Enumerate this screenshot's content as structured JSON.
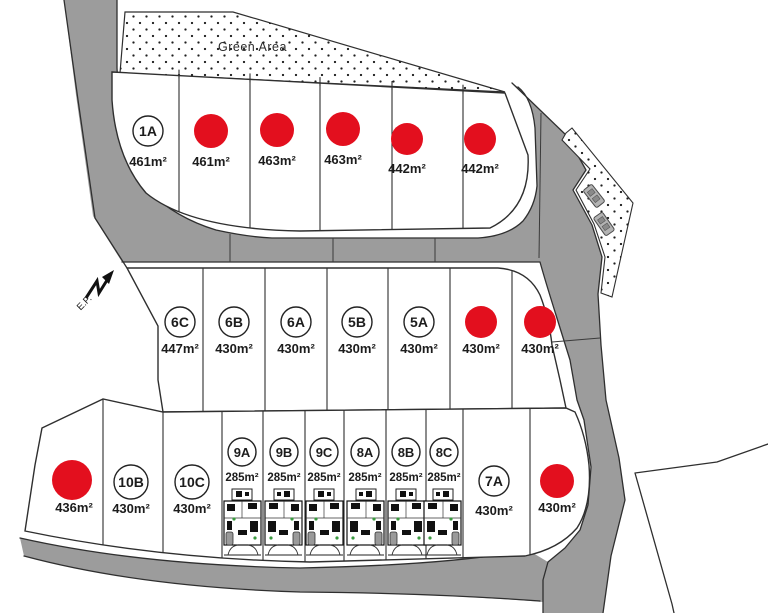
{
  "labels": {
    "green_area": "Green Area",
    "ep": "E.P."
  },
  "colors": {
    "sold_marker": "#e30f1e",
    "road": "#9c9c9c",
    "outline": "#2f2f2f"
  },
  "plots": {
    "top": [
      {
        "id": "1A",
        "area": "461m²",
        "sold": false
      },
      {
        "id": null,
        "area": "461m²",
        "sold": true
      },
      {
        "id": null,
        "area": "463m²",
        "sold": true
      },
      {
        "id": null,
        "area": "463m²",
        "sold": true
      },
      {
        "id": null,
        "area": "442m²",
        "sold": true
      },
      {
        "id": null,
        "area": "442m²",
        "sold": true
      }
    ],
    "middle": [
      {
        "id": "6C",
        "area": "447m²",
        "sold": false
      },
      {
        "id": "6B",
        "area": "430m²",
        "sold": false
      },
      {
        "id": "6A",
        "area": "430m²",
        "sold": false
      },
      {
        "id": "5B",
        "area": "430m²",
        "sold": false
      },
      {
        "id": "5A",
        "area": "430m²",
        "sold": false
      },
      {
        "id": null,
        "area": "430m²",
        "sold": true
      },
      {
        "id": null,
        "area": "430m²",
        "sold": true
      }
    ],
    "bottom": [
      {
        "id": null,
        "area": "436m²",
        "sold": true
      },
      {
        "id": "10B",
        "area": "430m²",
        "sold": false
      },
      {
        "id": "10C",
        "area": "430m²",
        "sold": false
      },
      {
        "id": "9A",
        "area": "285m²",
        "sold": false
      },
      {
        "id": "9B",
        "area": "285m²",
        "sold": false
      },
      {
        "id": "9C",
        "area": "285m²",
        "sold": false
      },
      {
        "id": "8A",
        "area": "285m²",
        "sold": false
      },
      {
        "id": "8B",
        "area": "285m²",
        "sold": false
      },
      {
        "id": "8C",
        "area": "285m²",
        "sold": false
      },
      {
        "id": "7A",
        "area": "430m²",
        "sold": false
      },
      {
        "id": null,
        "area": "430m²",
        "sold": true
      }
    ]
  }
}
